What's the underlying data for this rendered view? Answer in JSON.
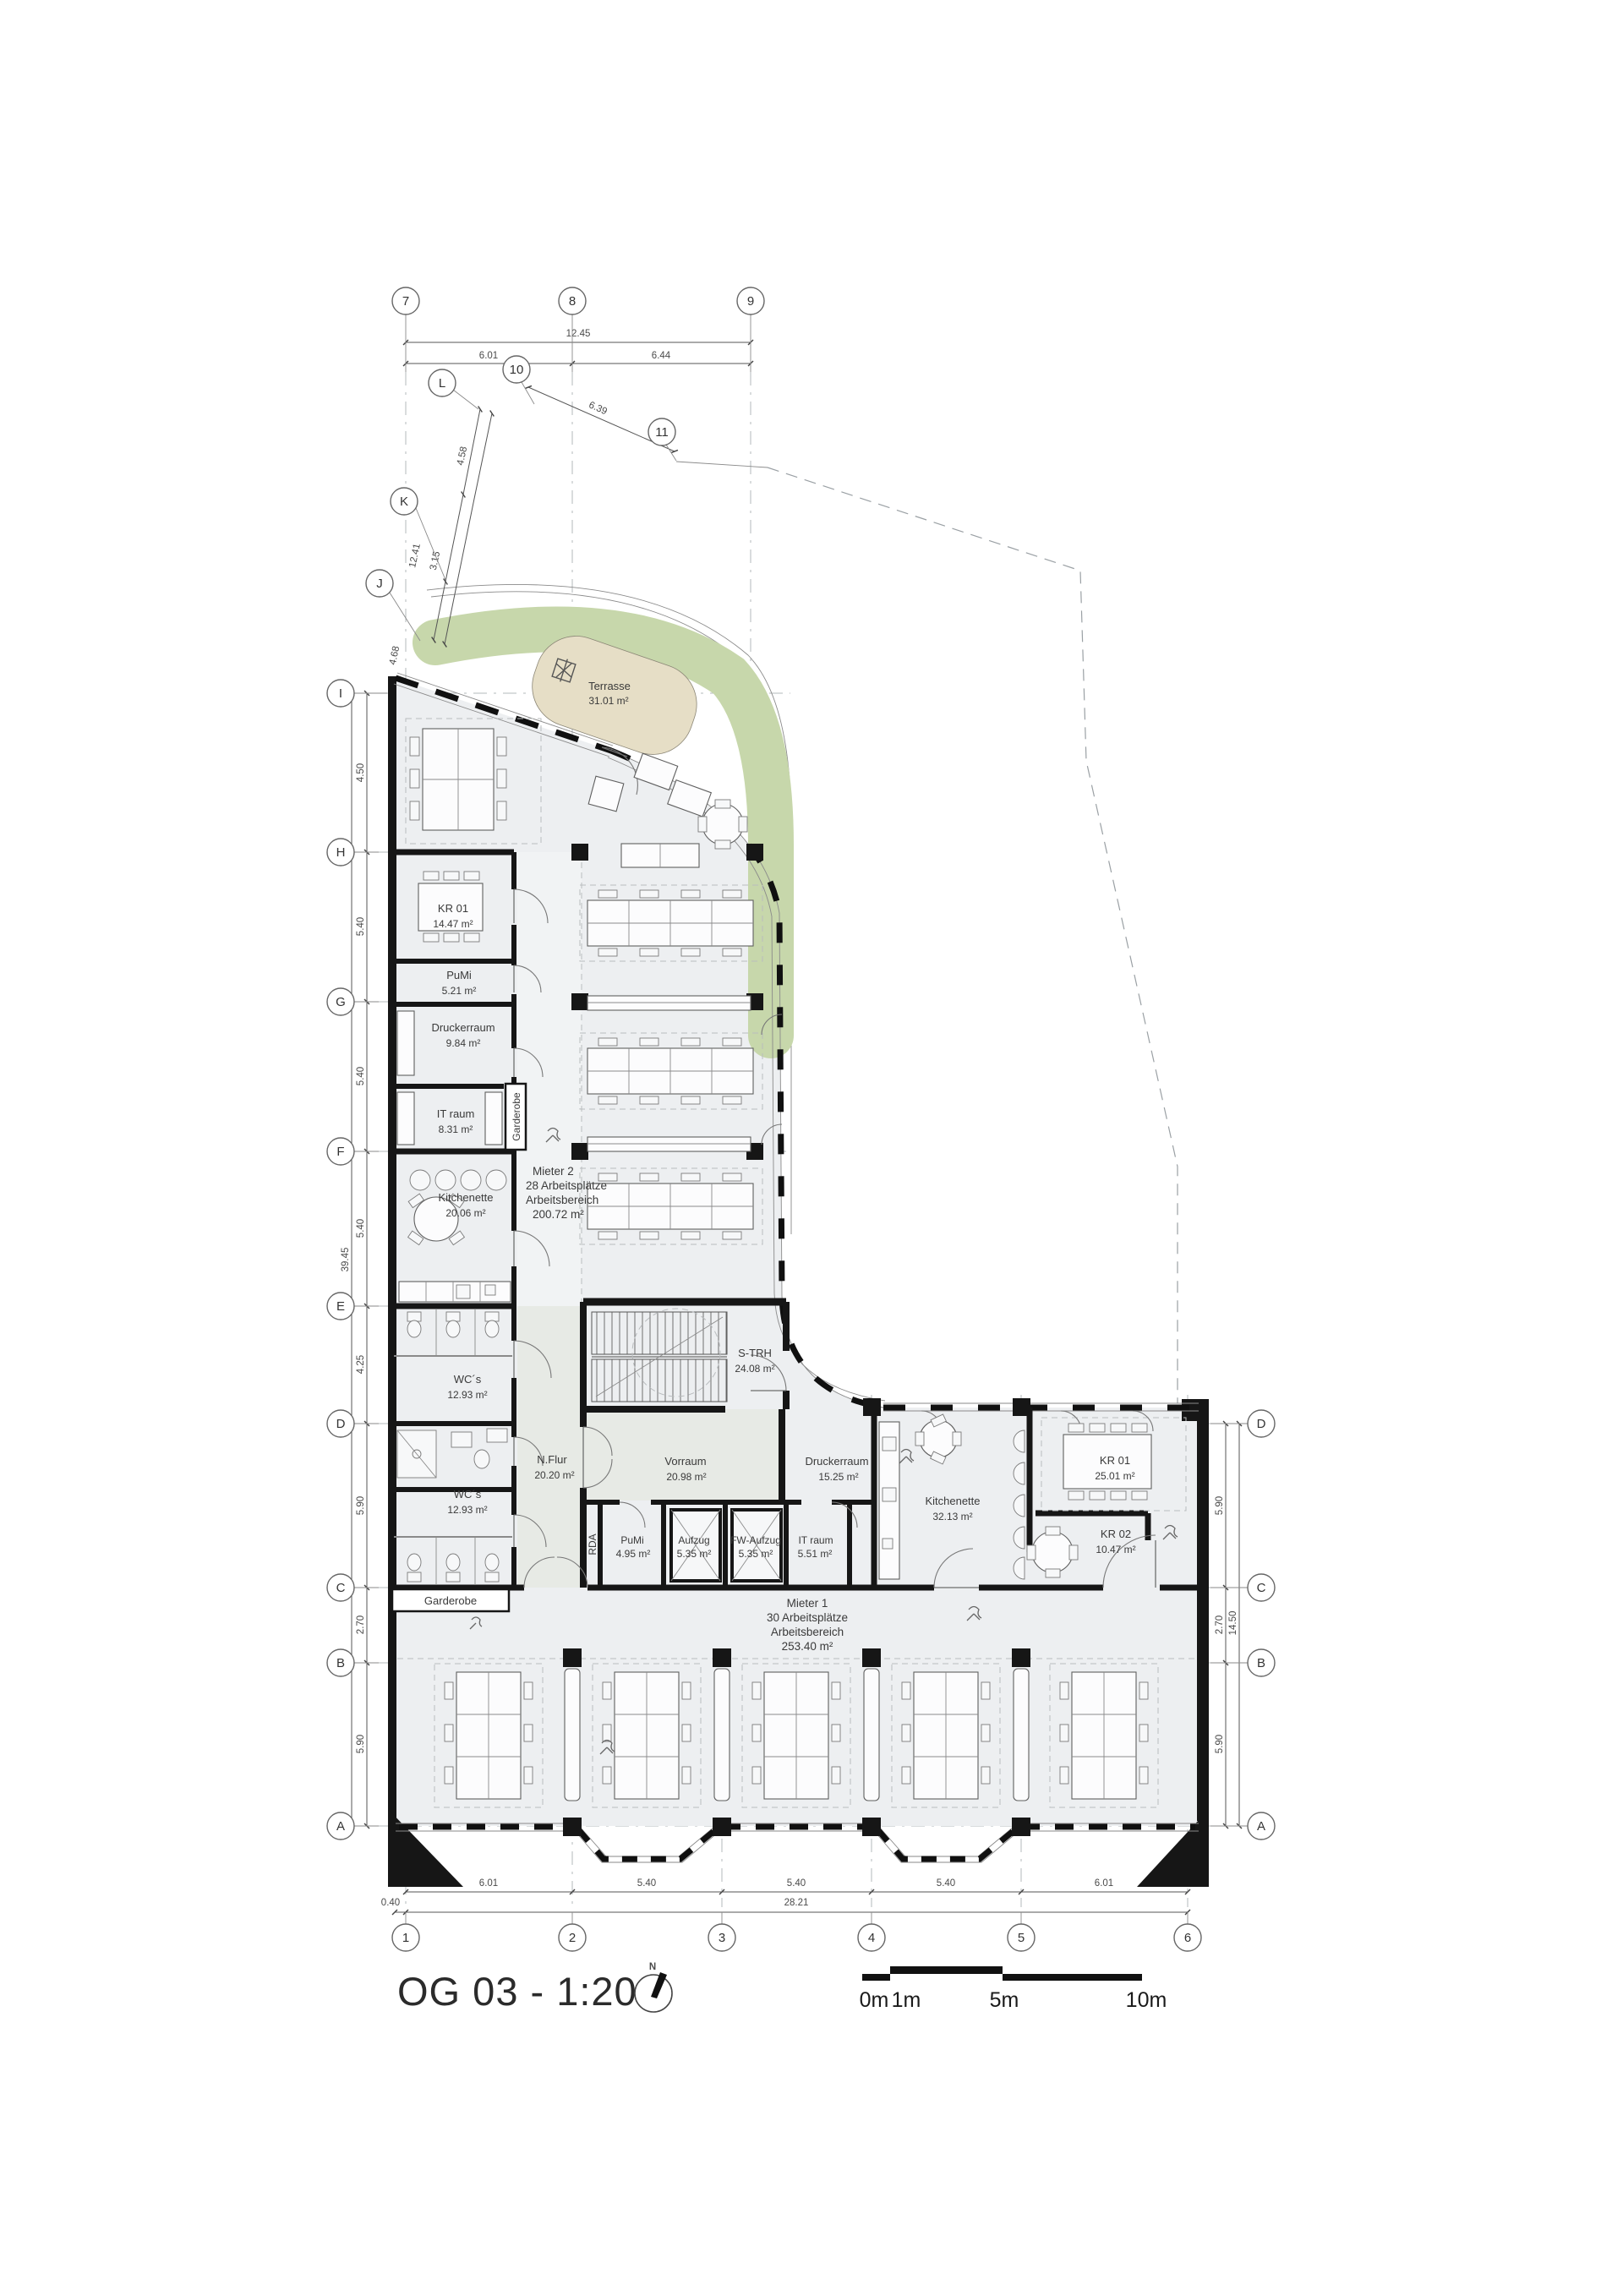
{
  "title": {
    "text": "OG 03 - 1:200"
  },
  "north": {
    "label": "N"
  },
  "scalebar": {
    "labels": [
      "0m",
      "1m",
      "5m",
      "10m"
    ]
  },
  "grid": {
    "top": [
      "7",
      "8",
      "9"
    ],
    "rotated": [
      "10",
      "L",
      "11",
      "K",
      "J"
    ],
    "left": [
      "I",
      "H",
      "G",
      "F",
      "E",
      "D",
      "C",
      "B",
      "A"
    ],
    "right": [
      "D",
      "C",
      "B",
      "A"
    ],
    "bottom": [
      "1",
      "2",
      "3",
      "4",
      "5",
      "6"
    ]
  },
  "dims": {
    "top_total": "12.45",
    "top_segments": [
      "6.01",
      "6.44"
    ],
    "rot": {
      "d639": "6.39",
      "d458": "4.58",
      "d1241": "12.41",
      "d315": "3.15",
      "d468": "4.68"
    },
    "left_segments": [
      "4.50",
      "5.40",
      "5.40",
      "5.40",
      "4.25",
      "5.90",
      "2.70",
      "5.90"
    ],
    "left_total": "39.45",
    "right_segments": [
      "5.90",
      "2.70",
      "5.90"
    ],
    "right_total": "14.50",
    "bottom_segments": [
      "6.01",
      "5.40",
      "5.40",
      "5.40",
      "6.01"
    ],
    "bottom_total": "28.21",
    "bottom_offset": "0.40"
  },
  "rooms": {
    "terrasse": {
      "name": "Terrasse",
      "area": "31.01 m²"
    },
    "kr01_left": {
      "name": "KR 01",
      "area": "14.47 m²"
    },
    "pumi_left": {
      "name": "PuMi",
      "area": "5.21 m²"
    },
    "druckerraum_left": {
      "name": "Druckerraum",
      "area": "9.84 m²"
    },
    "it_raum_left": {
      "name": "IT raum",
      "area": "8.31 m²"
    },
    "garderobe_top": {
      "name": "Garderobe"
    },
    "kitchenette_left": {
      "name": "Kitchenette",
      "area": "20.06 m²"
    },
    "wc_upper": {
      "name": "WC´s",
      "area": "12.93 m²"
    },
    "wc_lower": {
      "name": "WC´s",
      "area": "12.93 m²"
    },
    "garderobe_bottom": {
      "name": "Garderobe"
    },
    "strh": {
      "name": "S-TRH",
      "area": "24.08 m²"
    },
    "nflur": {
      "name": "N.Flur",
      "area": "20.20 m²"
    },
    "vorraum": {
      "name": "Vorraum",
      "area": "20.98 m²"
    },
    "rda": {
      "name": "RDA"
    },
    "pumi_core": {
      "name": "PuMi",
      "area": "4.95 m²"
    },
    "aufzug": {
      "name": "Aufzug",
      "area": "5.35 m²"
    },
    "fw_aufzug": {
      "name": "FW-Aufzug",
      "area": "5.35 m²"
    },
    "it_raum_core": {
      "name": "IT raum",
      "area": "5.51 m²"
    },
    "druckerraum_right": {
      "name": "Druckerraum",
      "area": "15.25 m²"
    },
    "kitchenette_right": {
      "name": "Kitchenette",
      "area": "32.13 m²"
    },
    "kr01_right": {
      "name": "KR 01",
      "area": "25.01 m²"
    },
    "kr02": {
      "name": "KR 02",
      "area": "10.47 m²"
    }
  },
  "tenants": {
    "mieter2": {
      "name": "Mieter 2",
      "line2": "28 Arbeitsplätze",
      "line3": "Arbeitsbereich",
      "area": "200.72 m²"
    },
    "mieter1": {
      "name": "Mieter 1",
      "line2": "30 Arbeitsplätze",
      "line3": "Arbeitsbereich",
      "area": "253.40 m²"
    }
  },
  "colors": {
    "green": "#c7d7ab",
    "beige": "#e6dec6",
    "floor": "#edeff1",
    "corridor": "#e7eae5",
    "wall": "#161616"
  }
}
